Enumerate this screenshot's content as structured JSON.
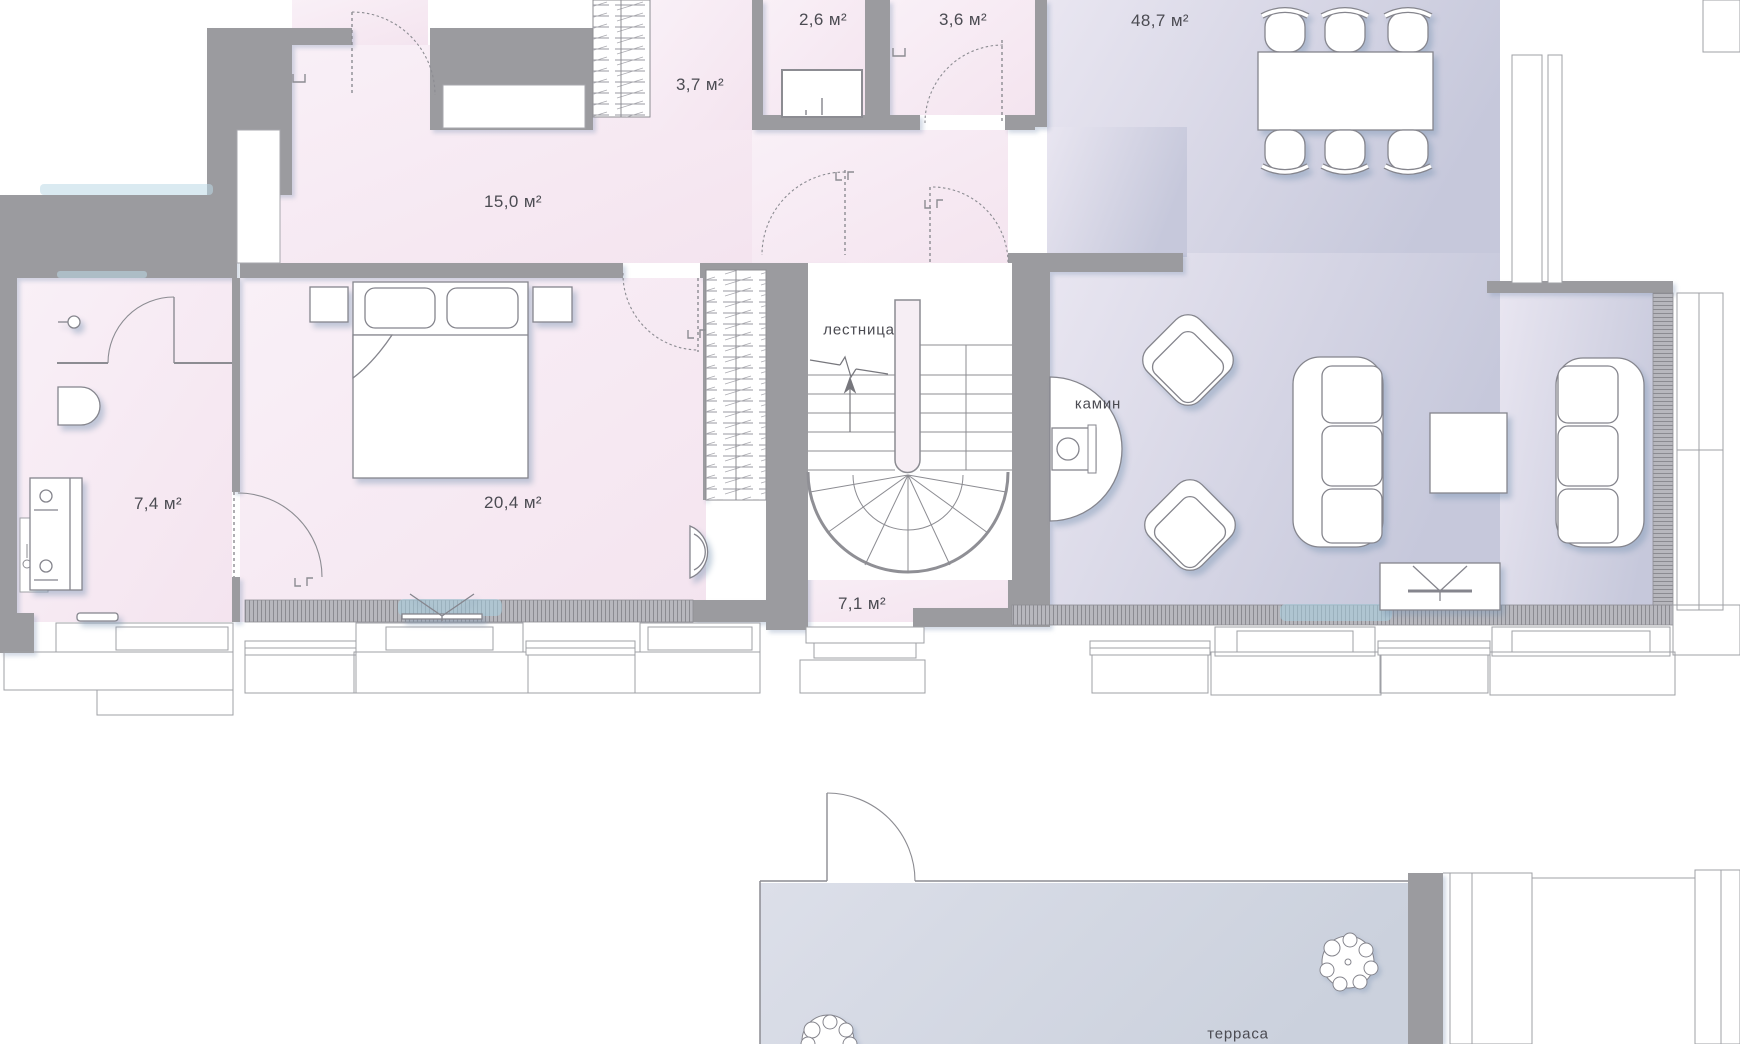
{
  "floor_plan": {
    "unit": "м²",
    "rooms": [
      {
        "id": "hallway",
        "area_label": "15,0 м²"
      },
      {
        "id": "closet",
        "area_label": "3,7 м²"
      },
      {
        "id": "wc",
        "area_label": "2,6 м²"
      },
      {
        "id": "storage",
        "area_label": "3,6 м²"
      },
      {
        "id": "living",
        "area_label": "48,7 м²"
      },
      {
        "id": "bathroom",
        "area_label": "7,4 м²"
      },
      {
        "id": "bedroom",
        "area_label": "20,4 м²"
      },
      {
        "id": "stair_hall",
        "area_label": "7,1 м²"
      }
    ],
    "annotations": {
      "staircase": "лестница",
      "fireplace": "камин",
      "terrace": "терраса"
    },
    "colors": {
      "wall": "#9b9b9f",
      "line": "#8c8c92",
      "room_pink": "#f8edf5",
      "room_lavender": "#d2d3e2",
      "terrace_fill": "#d4d8e3",
      "glow_accent": "#aad2e2",
      "text": "#4b4b52"
    }
  }
}
